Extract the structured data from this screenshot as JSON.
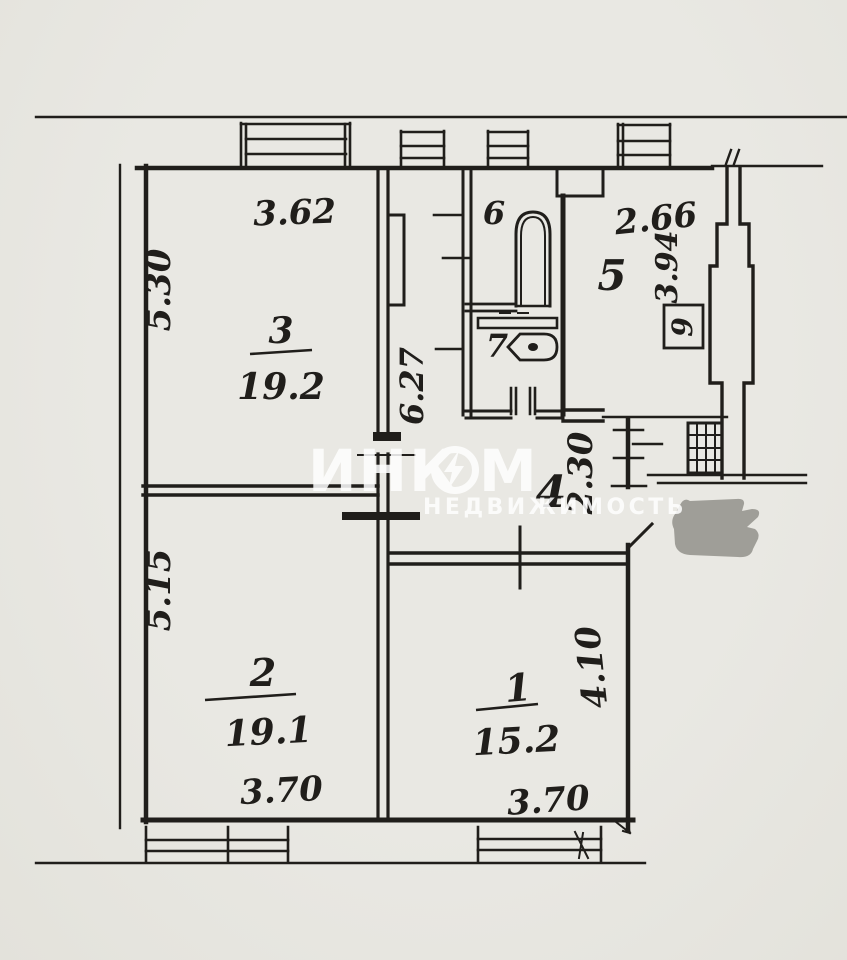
{
  "document": {
    "type_label": "apartment-floor-plan-scan"
  },
  "watermark": {
    "brand_left": "ИНК",
    "brand_o_icon": "lightning-circle-logo",
    "brand_right": "М",
    "subtitle": "НЕДВИЖИМОСТЬ"
  },
  "rooms": {
    "living_top": {
      "number": "3",
      "area": "19.2",
      "width": "3.62",
      "height": "5.30"
    },
    "living_left": {
      "number": "2",
      "area": "19.1",
      "width": "3.70",
      "height": "5.15"
    },
    "living_right": {
      "number": "1",
      "area": "15.2",
      "width": "3.70",
      "height": "4.10"
    },
    "hall": {
      "number": "4",
      "depth": "2.30"
    },
    "kitchen": {
      "number": "5",
      "width": "2.66",
      "height": "3.94",
      "shaft": "9"
    },
    "bathroom": {
      "number": "6"
    },
    "wc": {
      "number": "7"
    },
    "corridor": {
      "length": "6.27"
    }
  },
  "colors": {
    "paper": "#e7e6e1",
    "ink": "#201e1b",
    "redaction_blob": "#9b9a94",
    "watermark": "#ffffff"
  }
}
